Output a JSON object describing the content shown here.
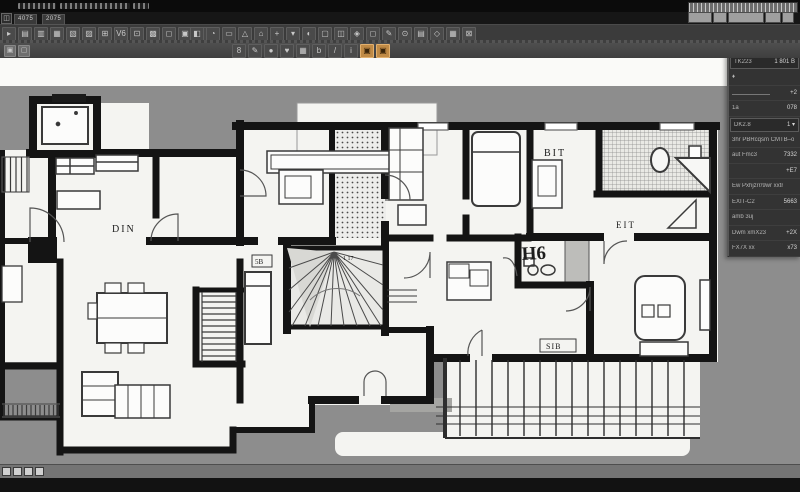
{
  "colors": {
    "accent_orange": "#c08a45",
    "canvas_gray": "#8d8d8d",
    "paper": "#f4f4f1",
    "wall": "#141414"
  },
  "titlebar": {
    "app_glyph": "◫",
    "tab1": "4075",
    "tab2": "2075"
  },
  "toolbars": {
    "row1_group1": [
      "▸",
      "▤",
      "▥",
      "▦",
      "▧",
      "▨",
      "⊞",
      "V6",
      "⊡",
      "▩",
      "◻",
      "▣",
      "◌"
    ],
    "row1_group2": [
      "◧",
      "◔",
      "▭",
      "△",
      "⌂",
      "+",
      "▾",
      "◐",
      "▢",
      "◫",
      "◈",
      "◻",
      "✎",
      "⊙",
      "▤",
      "◇",
      "▦",
      "⊠"
    ],
    "row2_left": [
      "▣",
      "▢"
    ],
    "row2_center": [
      {
        "g": "8"
      },
      {
        "g": "✎"
      },
      {
        "g": "●"
      },
      {
        "g": "♥"
      },
      {
        "g": "▦"
      },
      {
        "g": "b"
      },
      {
        "g": "/"
      },
      {
        "g": "i"
      },
      {
        "g": "▣",
        "accent": true
      },
      {
        "g": "▣",
        "accent": true
      }
    ],
    "ruler_buttons": [
      22,
      12,
      34,
      14,
      10
    ]
  },
  "panel": {
    "rows": [
      {
        "l": "CU TSC23",
        "v": ""
      },
      {
        "l": "XB CC723B",
        "v": ""
      },
      {
        "l": "TK223",
        "v": "1  801 B",
        "k": "field"
      },
      {
        "l": "♦",
        "v": ""
      },
      {
        "l": "",
        "v": "+2",
        "k": "slider"
      },
      {
        "l": "1a",
        "v": "078"
      },
      {
        "l": "DK2.8",
        "v": "1 ▾",
        "k": "field"
      },
      {
        "l": "3hr PBRcqsm CMTB–o",
        "v": ""
      },
      {
        "l": "aut Fmc3",
        "v": "7332"
      },
      {
        "l": "",
        "v": "+E7"
      },
      {
        "l": "Ew Pxhjzrr/9wr xxtr",
        "v": ""
      },
      {
        "l": "EXIT-C2",
        "v": "5663"
      },
      {
        "l": "amb 3uj",
        "v": ""
      },
      {
        "l": "Dwm xmX23",
        "v": "+2X"
      },
      {
        "l": "FX7X xx",
        "v": "x73"
      }
    ]
  },
  "plan": {
    "labels": {
      "din": "DIN",
      "bit": "BIT",
      "eit": "EIT",
      "h6": "H6",
      "sib": "SIB",
      "b5": "5B",
      "s117": "1 17"
    }
  }
}
